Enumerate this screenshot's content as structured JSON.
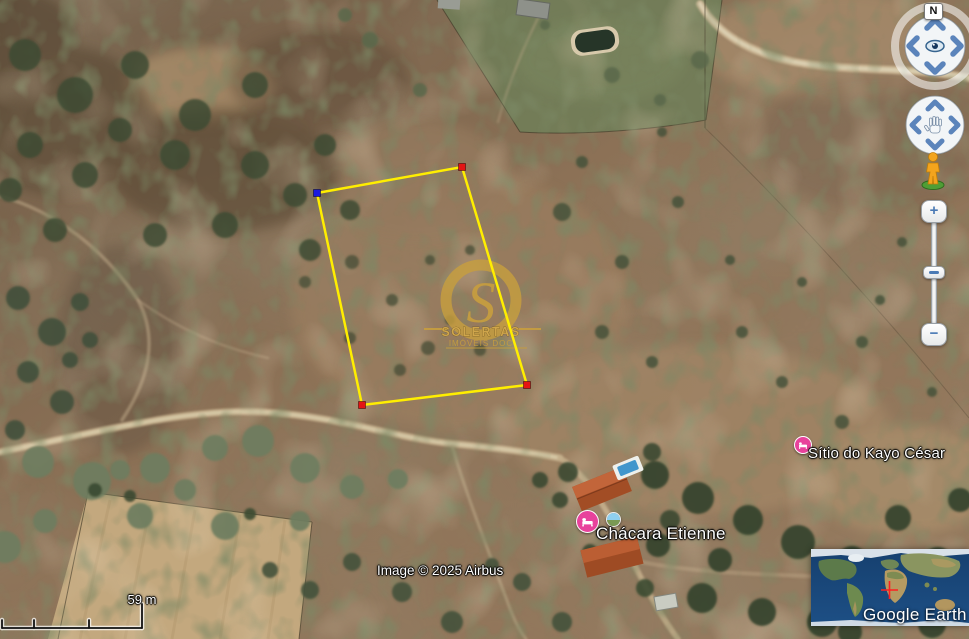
{
  "app": {
    "brand": "Google Earth"
  },
  "viewer": {
    "compass_north_label": "N",
    "scale_label": "59 m",
    "attribution": "Image © 2025 Airbus"
  },
  "watermark": {
    "title": "SOLERTAS",
    "subtitle": "IMÓVEIS DOC"
  },
  "places": [
    {
      "label": "Sítio do Kayo César",
      "icon": "lodging-pin"
    },
    {
      "label": "Chácara Etienne",
      "icon": "lodging-pin",
      "photo_icon": "photo-sphere"
    }
  ],
  "controls": {
    "zoom_in_label": "+",
    "zoom_out_label": "−",
    "street_view_icon": "pegman",
    "look_control_icon": "eye-joystick",
    "move_control_icon": "hand-joystick"
  },
  "parcel": {
    "outline_color": "#ffee00",
    "corner_marker_colors": [
      "#1a1adf",
      "#e41414",
      "#e41414",
      "#e41414"
    ]
  },
  "overview_map": {
    "brand": "Google Earth",
    "crosshair_color": "#ff1f1f"
  },
  "colors": {
    "place_pin_pink": "#e8429c",
    "watermark_gold": "#c79e3f",
    "control_arrow_blue": "#5b84bb",
    "scale_bar": "#111111",
    "label_text": "#ffffff"
  }
}
